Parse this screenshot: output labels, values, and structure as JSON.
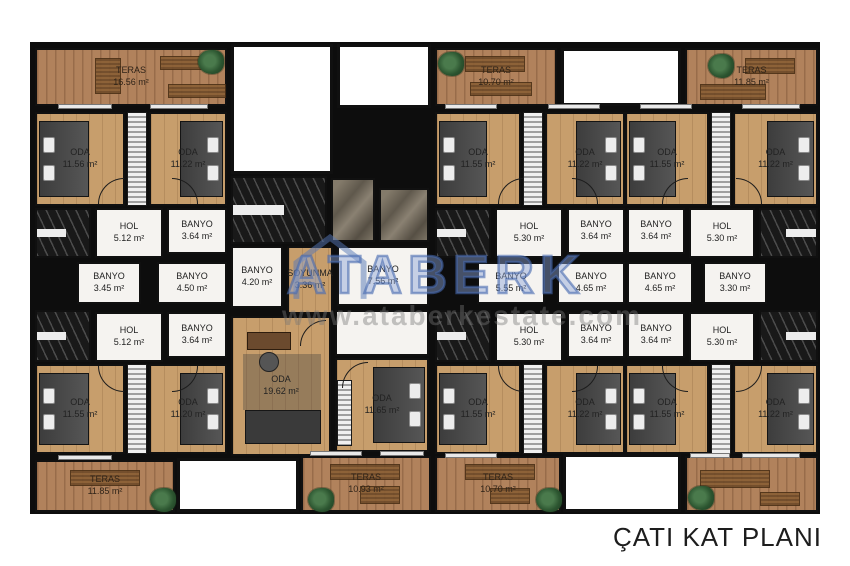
{
  "title": "ÇATI KAT PLANI",
  "watermark": {
    "brand": "ATABERK",
    "url": "www.ataberkestate.com"
  },
  "colors": {
    "wall": "#0d0d0d",
    "wood_floor": "#c79e6c",
    "terrace_deck": "#b1825c",
    "bathroom_floor": "#f5f3f0",
    "watermark_blue": "#5678b8",
    "watermark_gray": "#9a9a9a",
    "title_text": "#1d1d1d"
  },
  "rooms": [
    {
      "label": "TERAS",
      "area": "16.56 m²"
    },
    {
      "label": "ODA",
      "area": "11.56 m²"
    },
    {
      "label": "ODA",
      "area": "11.22 m²"
    },
    {
      "label": "HOL",
      "area": "5.12 m²"
    },
    {
      "label": "BANYO",
      "area": "3.64 m²"
    },
    {
      "label": "BANYO",
      "area": "3.45 m²"
    },
    {
      "label": "BANYO",
      "area": "4.50 m²"
    },
    {
      "label": "HOL",
      "area": "5.12 m²"
    },
    {
      "label": "BANYO",
      "area": "3.64 m²"
    },
    {
      "label": "ODA",
      "area": "11.55 m²"
    },
    {
      "label": "ODA",
      "area": "11.20 m²"
    },
    {
      "label": "TERAS",
      "area": "11.85 m²"
    },
    {
      "label": "BANYO",
      "area": "4.20 m²"
    },
    {
      "label": "SOYUNMA",
      "area": "3.36 m²"
    },
    {
      "label": "BANYO",
      "area": "7.56 m²"
    },
    {
      "label": "ODA",
      "area": "19.62 m²"
    },
    {
      "label": "ODA",
      "area": "11.65 m²"
    },
    {
      "label": "TERAS",
      "area": "10.93 m²"
    },
    {
      "label": "TERAS",
      "area": "10.70 m²"
    },
    {
      "label": "TERAS",
      "area": "10.70 m²"
    },
    {
      "label": "ODA",
      "area": "11.55 m²"
    },
    {
      "label": "ODA",
      "area": "11.22 m²"
    },
    {
      "label": "HOL",
      "area": "5.30 m²"
    },
    {
      "label": "BANYO",
      "area": "3.64 m²"
    },
    {
      "label": "BANYO",
      "area": "5.55 m²"
    },
    {
      "label": "BANYO",
      "area": "4.65 m²"
    },
    {
      "label": "HOL",
      "area": "5.30 m²"
    },
    {
      "label": "BANYO",
      "area": "3.64 m²"
    },
    {
      "label": "ODA",
      "area": "11.55 m²"
    },
    {
      "label": "ODA",
      "area": "11.22 m²"
    },
    {
      "label": "TERAS",
      "area": "11.85 m²"
    },
    {
      "label": "ODA",
      "area": "11.55 m²"
    },
    {
      "label": "ODA",
      "area": "11.22 m²"
    },
    {
      "label": "BANYO",
      "area": "3.64 m²"
    },
    {
      "label": "HOL",
      "area": "5.30 m²"
    },
    {
      "label": "BANYO",
      "area": "4.65 m²"
    },
    {
      "label": "BANYO",
      "area": "3.30 m²"
    },
    {
      "label": "BANYO",
      "area": "3.64 m²"
    },
    {
      "label": "HOL",
      "area": "5.30 m²"
    },
    {
      "label": "ODA",
      "area": "11.55 m²"
    },
    {
      "label": "ODA",
      "area": "11.22 m²"
    }
  ]
}
